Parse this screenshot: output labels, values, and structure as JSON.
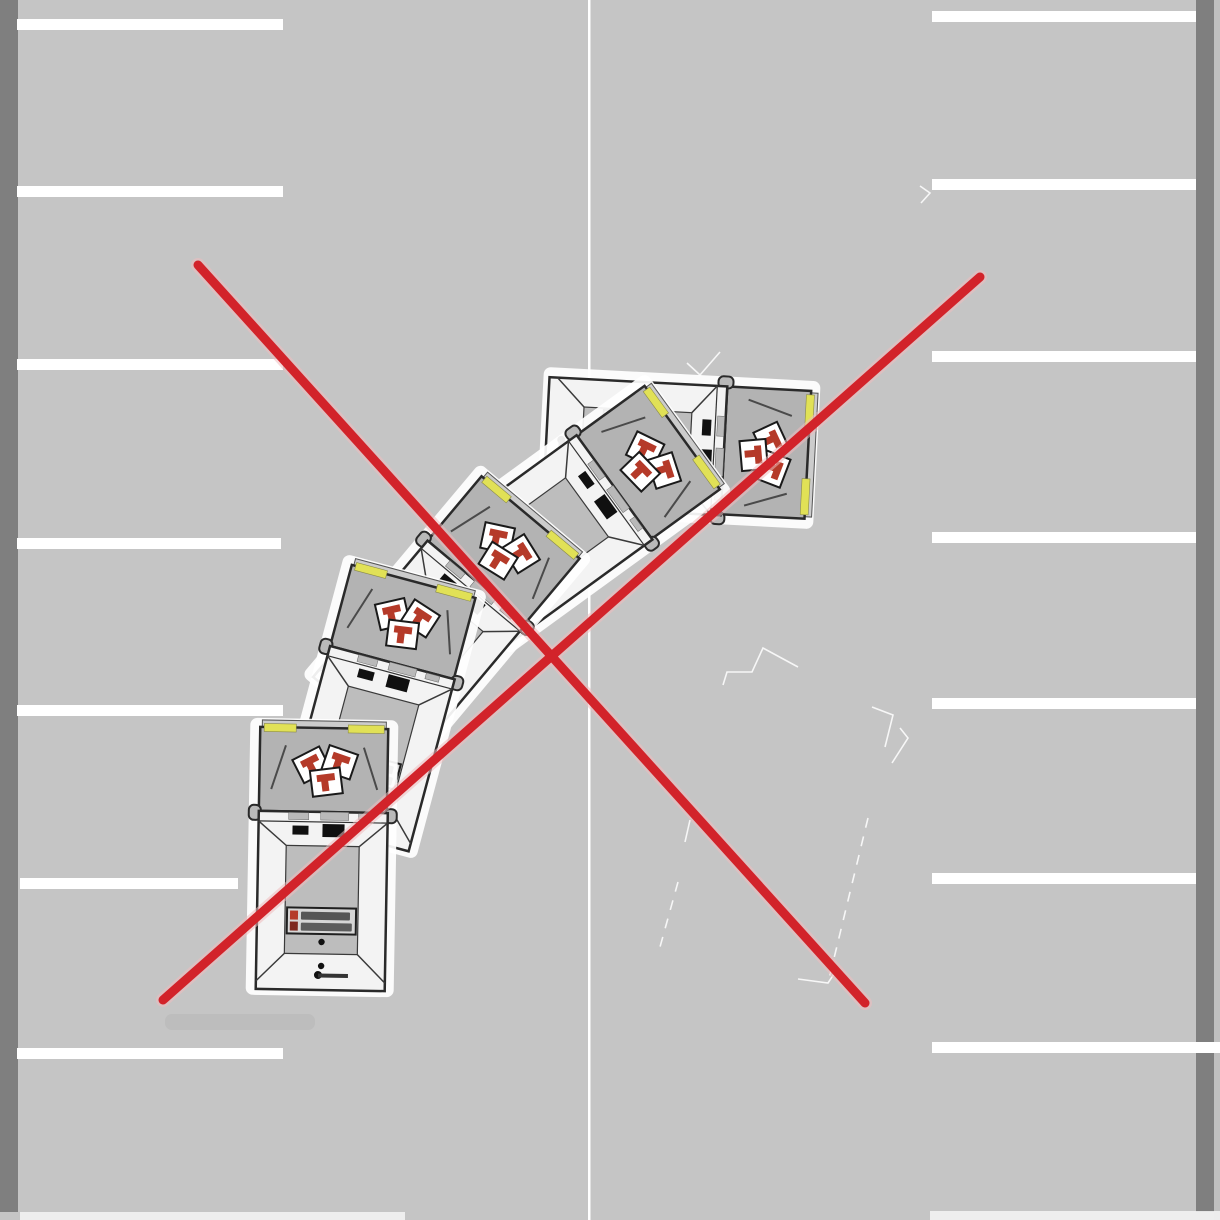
{
  "canvas": {
    "width": 1220,
    "height": 1220,
    "background_color": "#c5c5c5"
  },
  "road_markings": {
    "stripe_color": "#ffffff",
    "stripe_thickness": 11,
    "left_curb": {
      "x": 0,
      "y": 0,
      "width": 18,
      "height": 1212,
      "color": "#7f7f7f"
    },
    "right_curb": {
      "x": 1196,
      "y": 0,
      "width": 18,
      "height": 1212,
      "color": "#7f7f7f"
    },
    "right_curb_edge": {
      "x": 1214,
      "y": 0,
      "width": 6,
      "height": 1220,
      "color": "#c0c0c0"
    },
    "center_divider": {
      "x": 588,
      "width": 2.5,
      "y1": 0,
      "y2": 1220,
      "color": "#ffffff"
    },
    "left_bay_lines": [
      {
        "y": 19,
        "x1": 17,
        "x2": 283
      },
      {
        "y": 186,
        "x1": 17,
        "x2": 283
      },
      {
        "y": 359,
        "x1": 17,
        "x2": 283
      },
      {
        "y": 538,
        "x1": 17,
        "x2": 281
      },
      {
        "y": 705,
        "x1": 17,
        "x2": 283
      },
      {
        "y": 878,
        "x1": 20,
        "x2": 238
      },
      {
        "y": 1048,
        "x1": 17,
        "x2": 283
      }
    ],
    "right_bay_lines": [
      {
        "y": 11,
        "x1": 932,
        "x2": 1196
      },
      {
        "y": 179,
        "x1": 932,
        "x2": 1196
      },
      {
        "y": 351,
        "x1": 932,
        "x2": 1196
      },
      {
        "y": 532,
        "x1": 932,
        "x2": 1196
      },
      {
        "y": 698,
        "x1": 932,
        "x2": 1196
      },
      {
        "y": 873,
        "x1": 932,
        "x2": 1196
      },
      {
        "y": 1042,
        "x1": 932,
        "x2": 1220
      }
    ],
    "bottom_edge_strips": [
      {
        "x": 20,
        "y": 1212,
        "width": 385,
        "height": 8
      },
      {
        "x": 930,
        "y": 1211,
        "width": 290,
        "height": 9
      }
    ]
  },
  "ghost_outline": {
    "color": "#ffffff",
    "opacity": 0.85,
    "stroke_width": 1.6,
    "segments": [
      {
        "points": [
          [
            687,
            363
          ],
          [
            700,
            375
          ],
          [
            720,
            352
          ]
        ],
        "dashed": false
      },
      {
        "points": [
          [
            723,
            685
          ],
          [
            727,
            672
          ],
          [
            752,
            672
          ],
          [
            763,
            648
          ],
          [
            798,
            667
          ]
        ],
        "dashed": false
      },
      {
        "points": [
          [
            872,
            707
          ],
          [
            893,
            715
          ],
          [
            885,
            747
          ]
        ],
        "dashed": false
      },
      {
        "points": [
          [
            900,
            728
          ],
          [
            908,
            738
          ],
          [
            892,
            763
          ]
        ],
        "dashed": false
      },
      {
        "points": [
          [
            868,
            818
          ],
          [
            828,
            983
          ]
        ],
        "dashed": true
      },
      {
        "points": [
          [
            690,
            820
          ],
          [
            685,
            842
          ]
        ],
        "dashed": false
      },
      {
        "points": [
          [
            678,
            882
          ],
          [
            660,
            947
          ]
        ],
        "dashed": true
      },
      {
        "points": [
          [
            798,
            979
          ],
          [
            828,
            983
          ],
          [
            838,
            968
          ]
        ],
        "dashed": false
      },
      {
        "points": [
          [
            920,
            186
          ],
          [
            930,
            193
          ],
          [
            921,
            203
          ]
        ],
        "dashed": false
      }
    ]
  },
  "trucks": {
    "colors": {
      "halo": "#ffffff",
      "outline": "#2a2a2a",
      "roof": "#b3b3b3",
      "body": "#f3f3f3",
      "floor": "#bdbdbd",
      "front_bumper": "#cccccc",
      "corner_yellow": "#e1e156",
      "logo_card": "#ffffff",
      "logo_red": "#b53a29",
      "black_detail": "#101010",
      "label_bg": "#d6d6d6",
      "label_text": "#474747"
    },
    "length": 277,
    "width": 148,
    "positions": [
      {
        "name": "truck-position-5",
        "x": 678,
        "y": 448,
        "rotation_deg": 93
      },
      {
        "name": "truck-position-4",
        "x": 577,
        "y": 514,
        "rotation_deg": 54
      },
      {
        "name": "truck-position-3",
        "x": 447,
        "y": 617,
        "rotation_deg": 40
      },
      {
        "name": "truck-position-2",
        "x": 380,
        "y": 707,
        "rotation_deg": 15
      },
      {
        "name": "truck-position-1",
        "x": 322,
        "y": 858,
        "rotation_deg": 1
      }
    ]
  },
  "prohibition_cross": {
    "color": "#d2232a",
    "halo_color": "#f0bcbe",
    "stroke_width": 9,
    "halo_width": 14,
    "lines": [
      {
        "x1": 198,
        "y1": 265,
        "x2": 865,
        "y2": 1003
      },
      {
        "x1": 980,
        "y1": 277,
        "x2": 163,
        "y2": 1000
      }
    ]
  },
  "artifacts": {
    "shadow_smudge": {
      "x": 165,
      "y": 1014,
      "width": 150,
      "height": 16,
      "color": "#b2b2b2",
      "opacity": 0.4
    }
  }
}
